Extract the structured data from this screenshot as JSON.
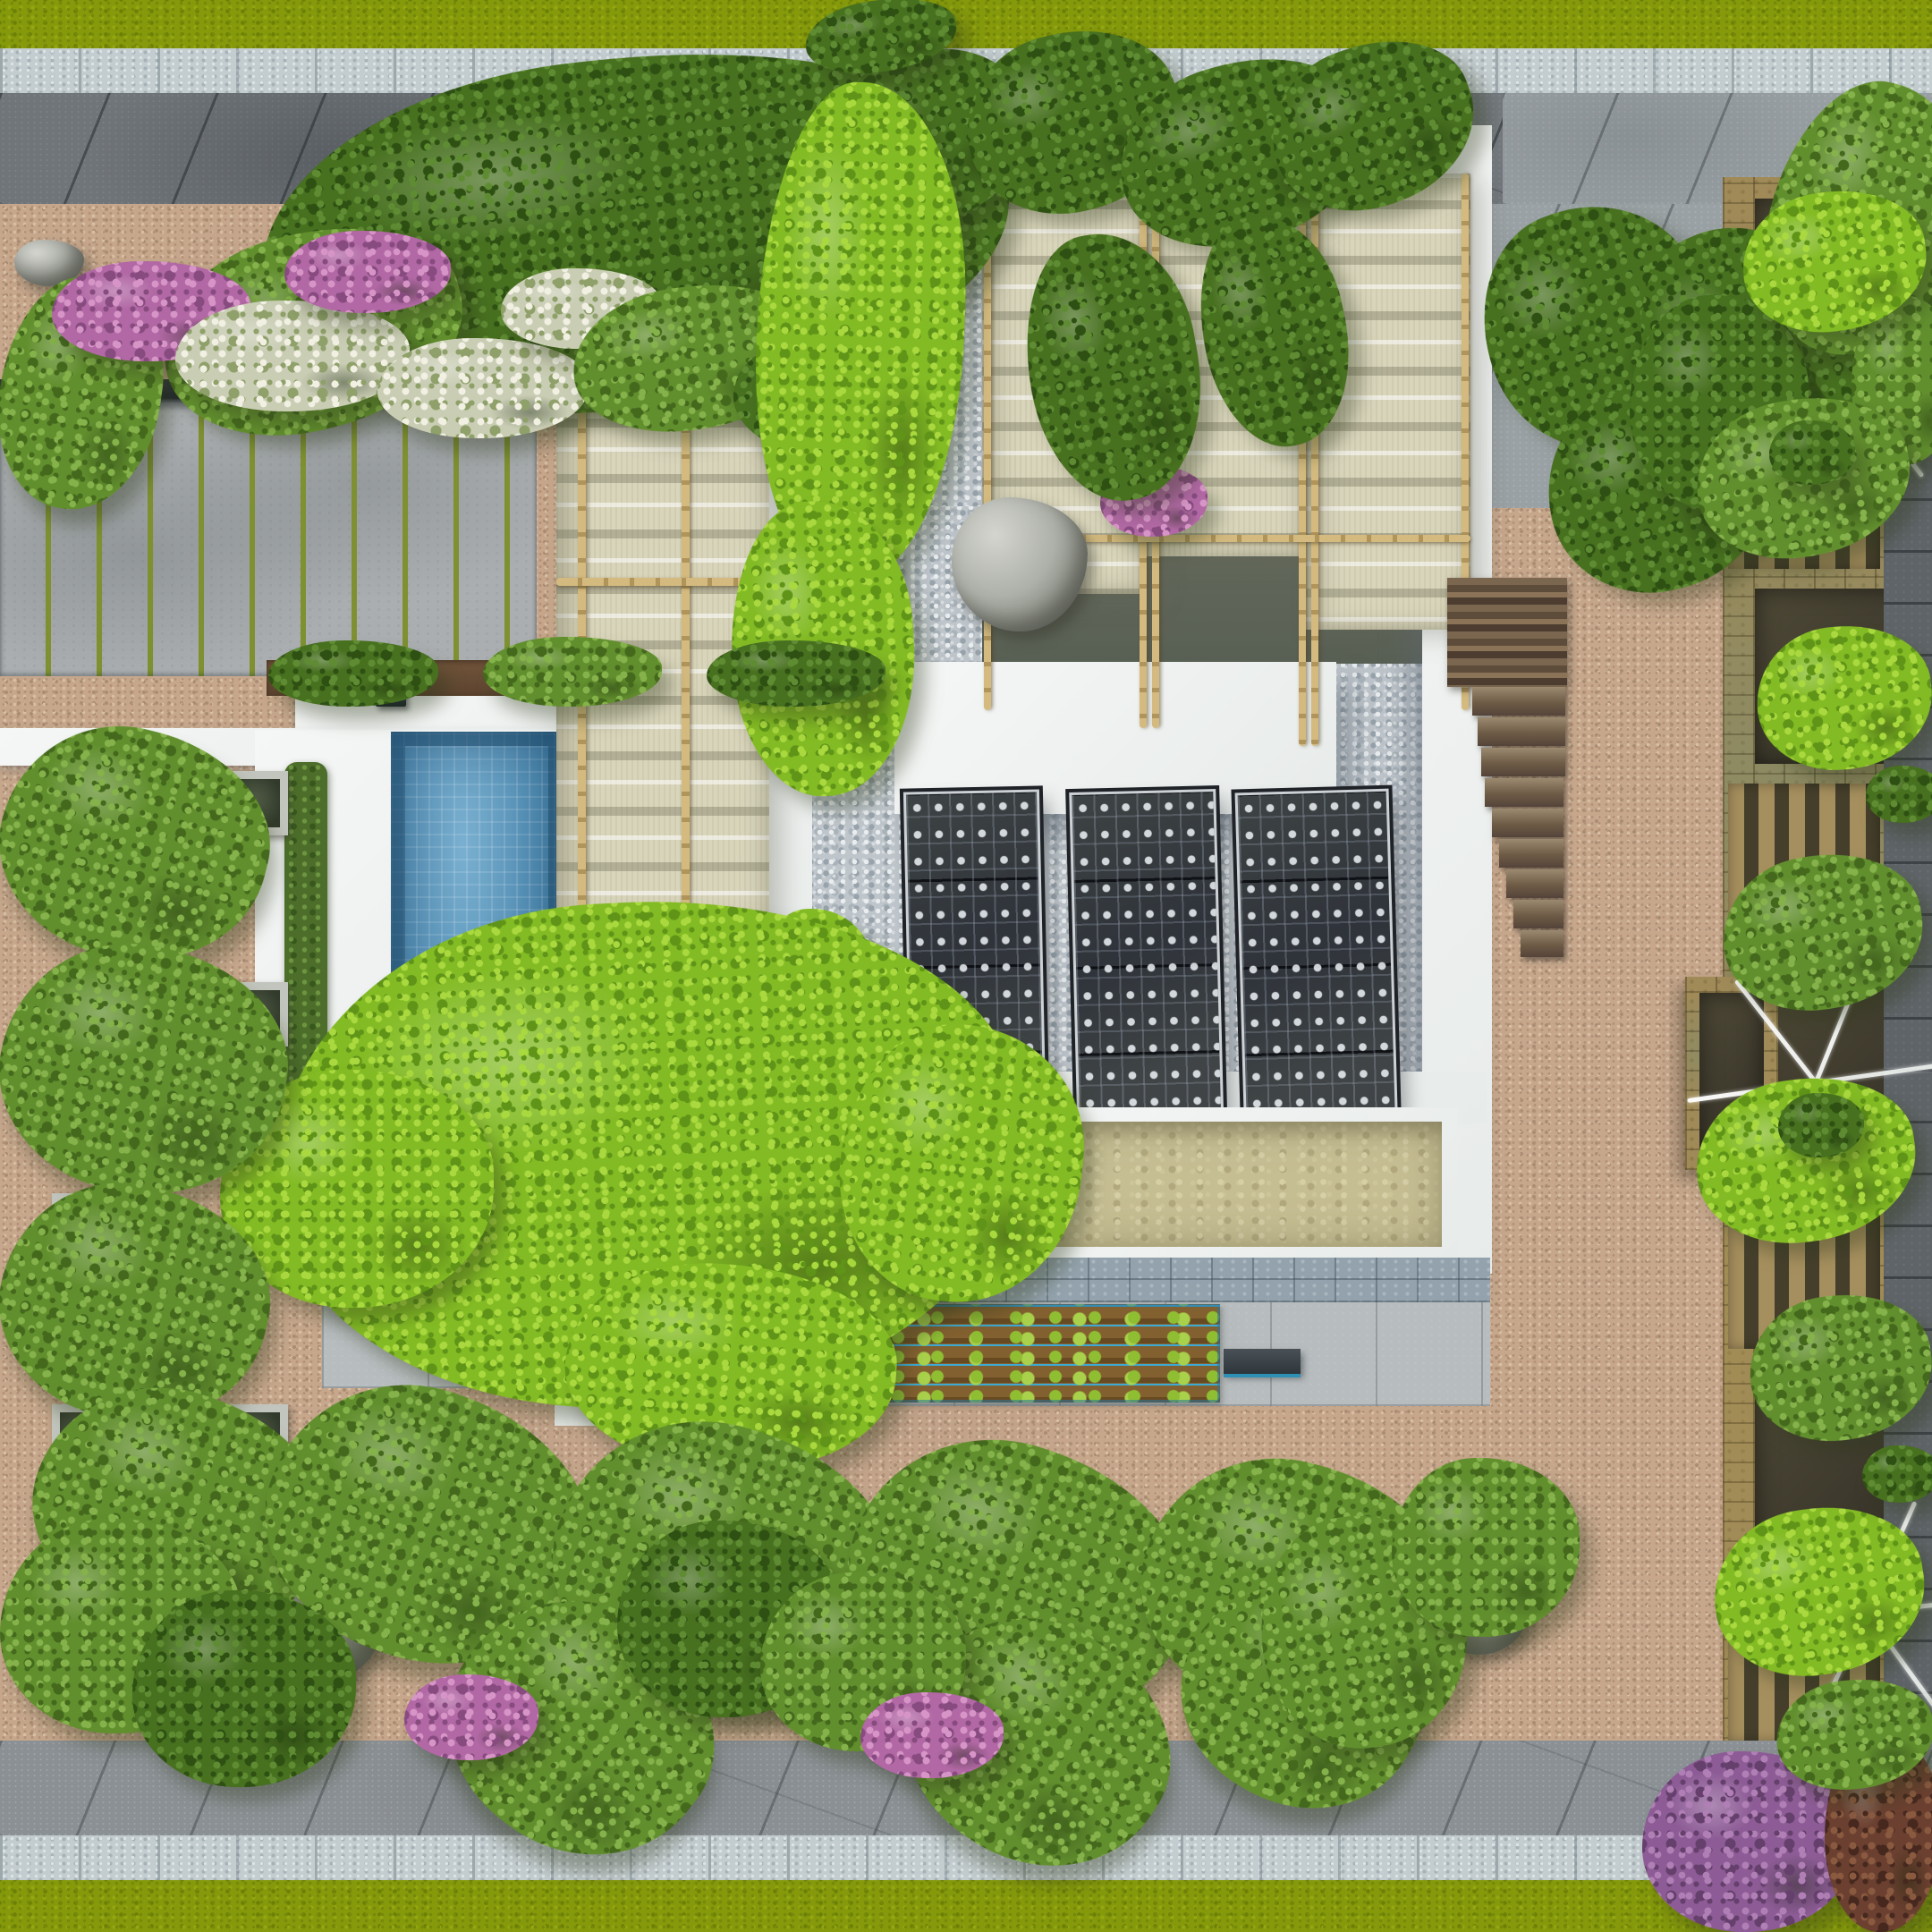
{
  "scene": {
    "description": "Top-down aerial 3D architectural rendering of a modern villa rooftop and courtyard garden",
    "inventory": {
      "solar_panels": 3,
      "swimming_pools": 1,
      "fabric_pergolas": 2,
      "water_features": 1,
      "water_jets": 2,
      "vegetable_rows": 5,
      "planter_boxes_right_column": 7,
      "white_umbrella_frames": 3,
      "tree_grate_squares_west": 6,
      "tree_grate_squares_south": 4,
      "wooden_stair_steps": 9,
      "boulders": 7,
      "deck_lights": 5
    }
  },
  "palette": {
    "lawn": "#85990b",
    "paverDark": "#70757a",
    "paverMid": "#9aa1a4",
    "curb": "#c3cccf",
    "gravelPink": "#c6a78c",
    "pebble": "#bec5cb",
    "concrete": "#aaaeb0",
    "jointGreen": "#7e9030",
    "white": "#f5f7f6",
    "fabric": "#d9d5bb",
    "bamboo": "#c2a869",
    "poolBlue": "#4583ab",
    "solarPanel": "#2f333a",
    "waterTan": "#c6be93",
    "ledgeStone": "#93a2ac",
    "slab": "#b7bcbe",
    "soil": "#7a582c",
    "lettuce": "#8fbe33",
    "irrigationBlue": "#3caad2",
    "wood": "#6f5b46",
    "planterStone": "#a08a58",
    "leafBright": "#83bb24",
    "leafMid": "#628f2e",
    "leafDark": "#47701f",
    "flowerPink": "#b168a4",
    "flowerWhite": "#c9cdb4",
    "darkPaver": "#5f6468"
  }
}
